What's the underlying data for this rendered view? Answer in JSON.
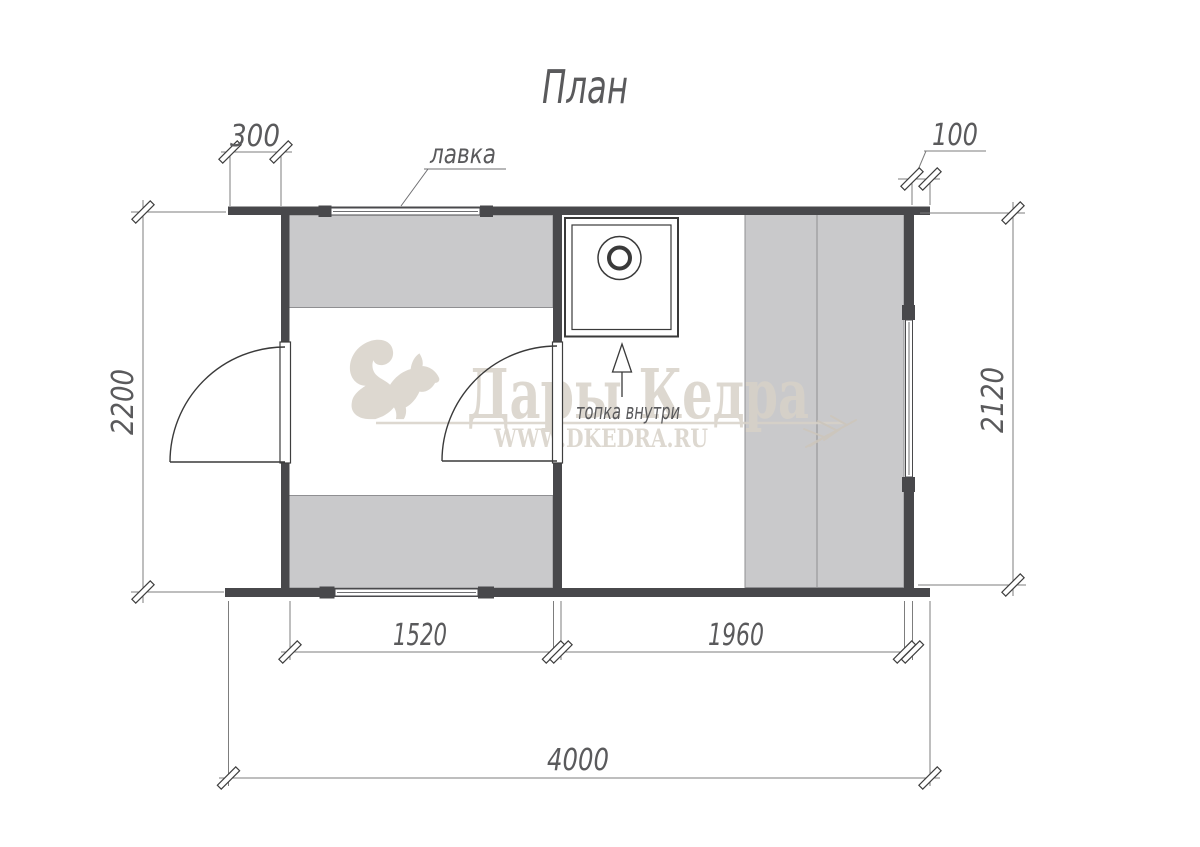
{
  "title": "План",
  "plan_labels": {
    "bench": "лавка",
    "stove_note": "топка внутри"
  },
  "dimensions": {
    "porch_depth": "300",
    "right_overhang": "100",
    "left_outer_height": "2200",
    "right_inner_height": "2120",
    "steam_room_width": "1520",
    "front_room_width": "1960",
    "total_length": "4000"
  },
  "watermark": {
    "brand": "Дары Кедра",
    "website": "WWW.DKEDRA.RU"
  },
  "colors": {
    "wall": "#48484b",
    "bench": "#c9c9cb",
    "benchline": "#8f8f92",
    "ink": "#3e3e3e",
    "dimline": "#7d7d7d",
    "text": "#5a5a5c",
    "watermark": "#d8d2c8",
    "paper": "#ffffff"
  }
}
